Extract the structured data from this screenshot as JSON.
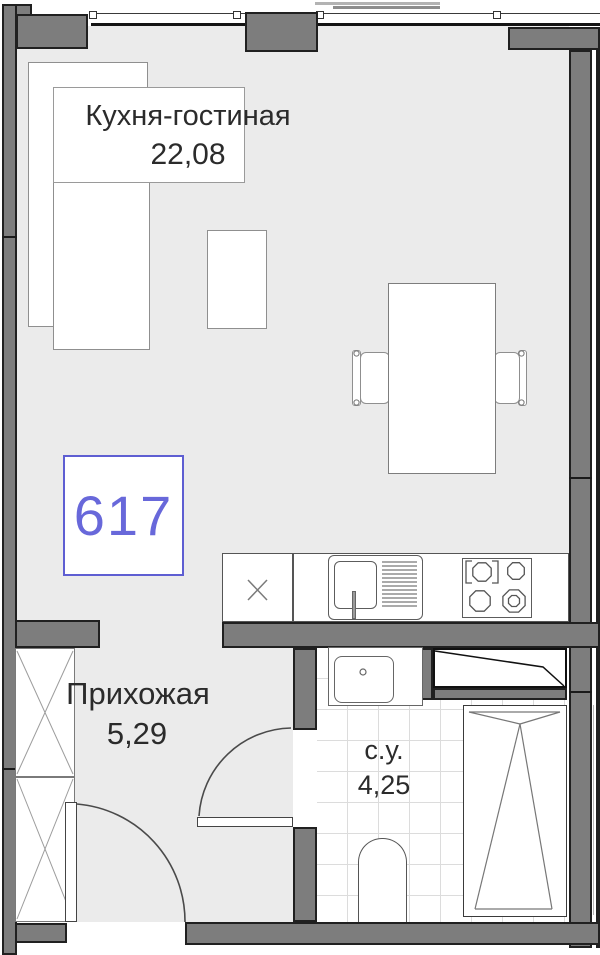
{
  "plan": {
    "unit": {
      "number": "617"
    },
    "rooms": [
      {
        "name": "Кухня-гостиная",
        "area": "22,08"
      },
      {
        "name": "Прихожая",
        "area": "5,29"
      },
      {
        "name": "с.у.",
        "area": "4,25"
      }
    ],
    "colors": {
      "wall_fill": "#7d7d7d",
      "wall_outline": "#202020",
      "floor_fill": "#ebebeb",
      "unit_accent": "#6868da",
      "unit_border": "#5e5ed2",
      "tile_line": "#dcdcdc",
      "text": "#2b2b2b"
    }
  }
}
